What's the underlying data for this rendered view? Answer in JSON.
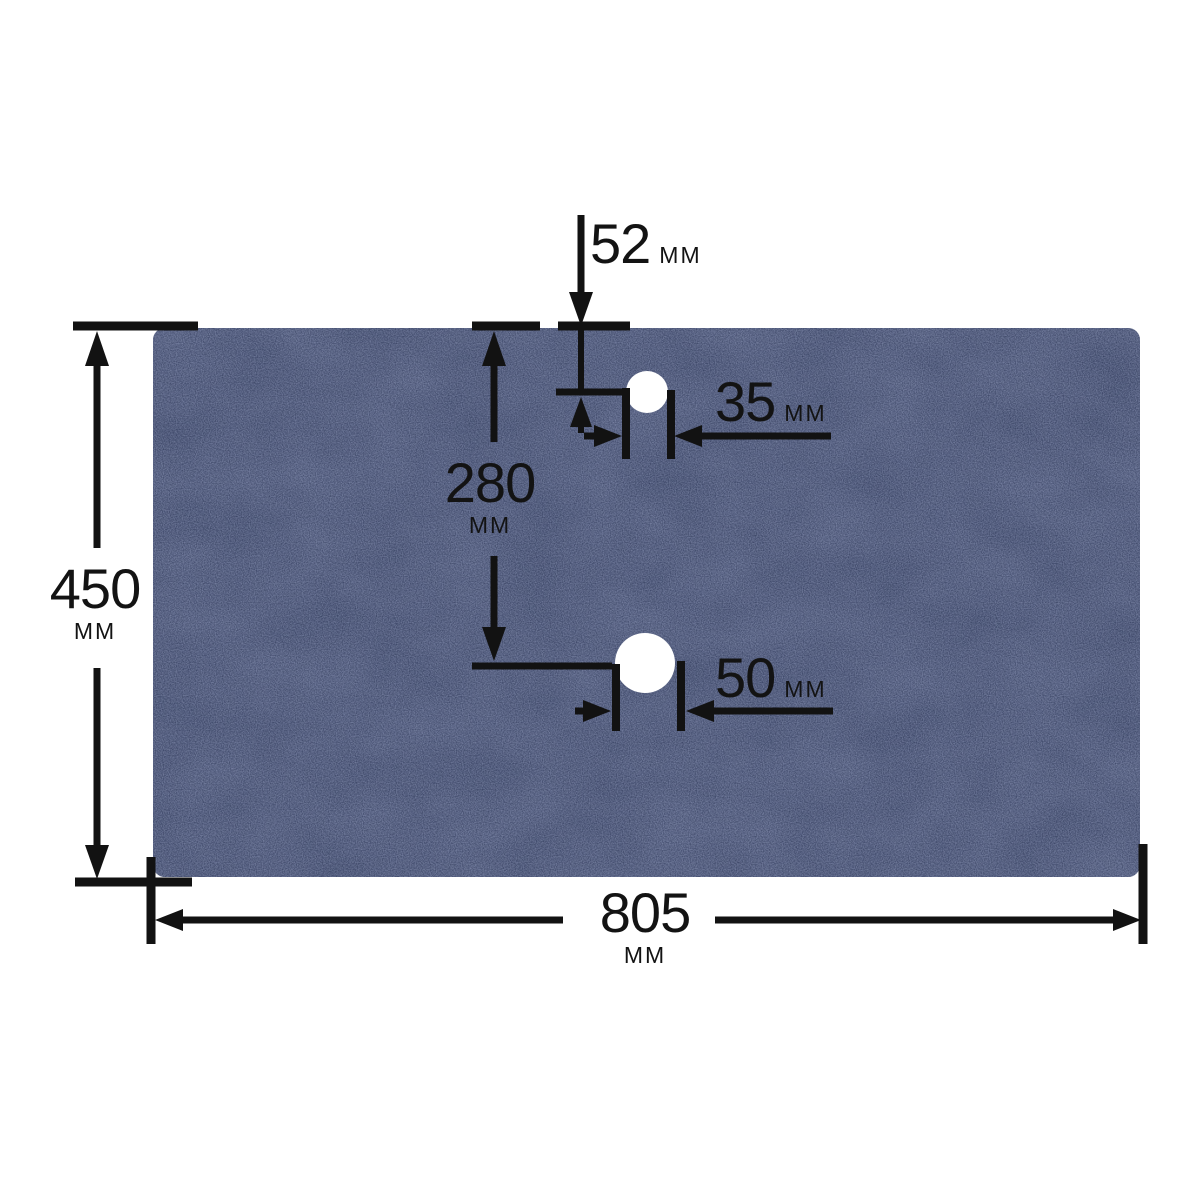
{
  "colors": {
    "background": "#ffffff",
    "panel_base": "#5b6583",
    "panel_speckle_light": "#8d97ad",
    "panel_speckle_dark": "#454f6e",
    "hole_fill": "#ffffff",
    "line_color": "#121212"
  },
  "labels": {
    "hole1_offset_from_top": {
      "num": "52",
      "unit": "MM"
    },
    "hole1_diameter": {
      "num": "35",
      "unit": "MM"
    },
    "hole_vertical_spacing": {
      "num": "280",
      "unit": "MM"
    },
    "board_height": {
      "num": "450",
      "unit": "MM"
    },
    "hole2_diameter": {
      "num": "50",
      "unit": "MM"
    },
    "board_width": {
      "num": "805",
      "unit": "MM"
    }
  }
}
